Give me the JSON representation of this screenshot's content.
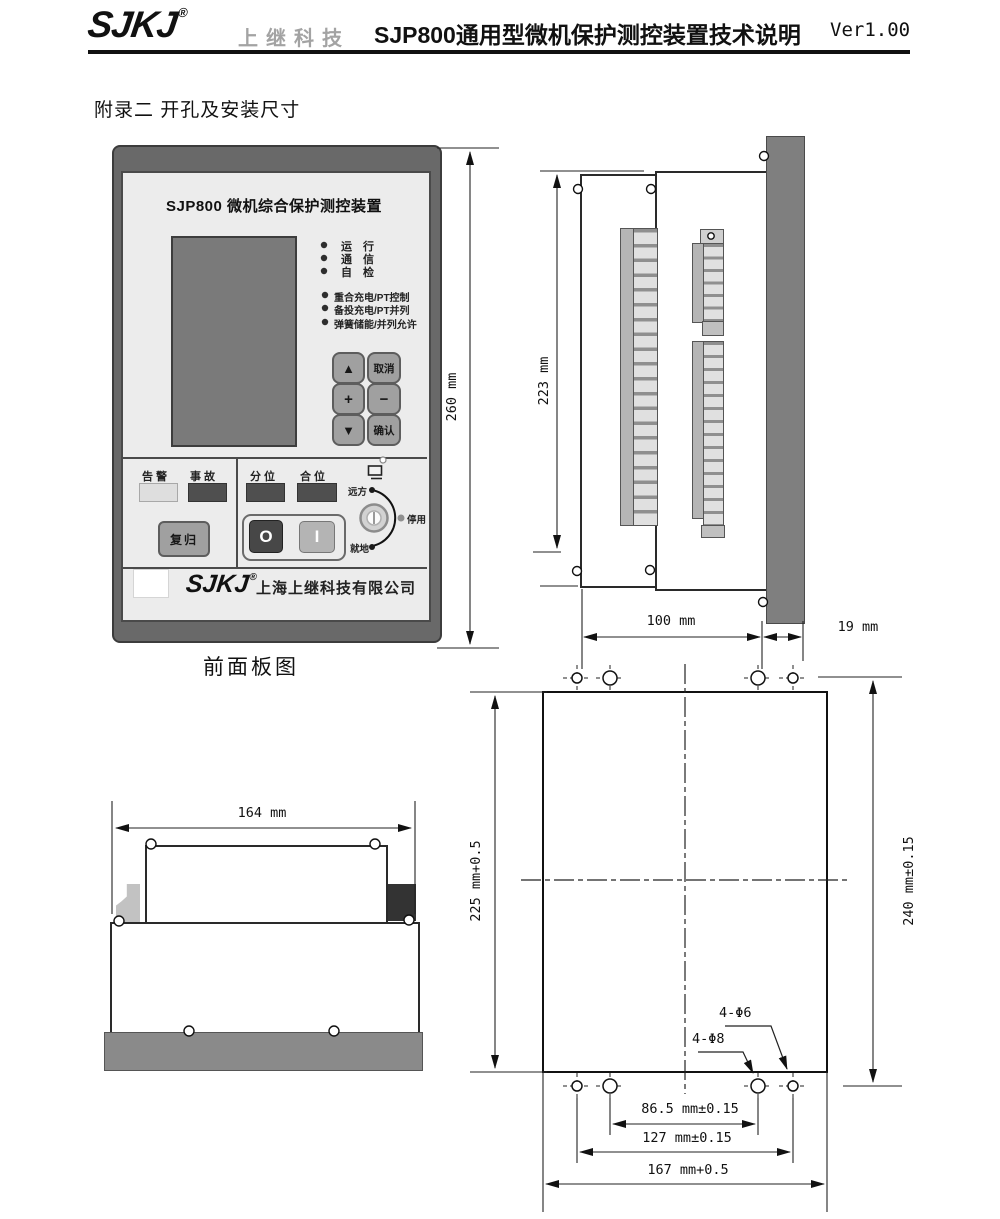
{
  "header": {
    "logo": "SJKJ",
    "reg": "®",
    "brand": "上继科技",
    "title": "SJP800通用型微机保护测控装置技术说明",
    "version": "Ver1.00"
  },
  "section_title": "附录二 开孔及安装尺寸",
  "front_panel": {
    "device_title": "SJP800 微机综合保护测控装置",
    "led_run": "运　行",
    "led_comm": "通　信",
    "led_check": "自　检",
    "led_f1": "重合充电/PT控制",
    "led_f2": "备投充电/PT并列",
    "led_f3": "弹簧储能/并列允许",
    "key_up": "▲",
    "key_cancel": "取消",
    "key_plus": "+",
    "key_minus": "−",
    "key_down": "▼",
    "key_confirm": "确认",
    "lbl_alarm": "告警",
    "lbl_fault": "事故",
    "btn_reset": "复归",
    "lbl_open": "分位",
    "lbl_closed": "合位",
    "sw_off": "O",
    "sw_on": "I",
    "knob_remote": "远方",
    "knob_disable": "停用",
    "knob_local": "就地",
    "footer_logo": "SJKJ",
    "footer_reg": "®",
    "footer_company": "上海上继科技有限公司",
    "caption": "前面板图"
  },
  "dims": {
    "front_height": "260 mm",
    "side_height": "223 mm",
    "depth": "100 mm",
    "panel_thk": "19 mm",
    "top_width": "164 mm",
    "cutout_h": "225 mm+0.5",
    "holes_v": "240 mm±0.15",
    "holes_h_inner": "86.5 mm±0.15",
    "holes_h_outer": "127 mm±0.15",
    "cutout_w": "167 mm+0.5",
    "hole_d6": "4-Φ6",
    "hole_d8": "4-Φ8"
  }
}
